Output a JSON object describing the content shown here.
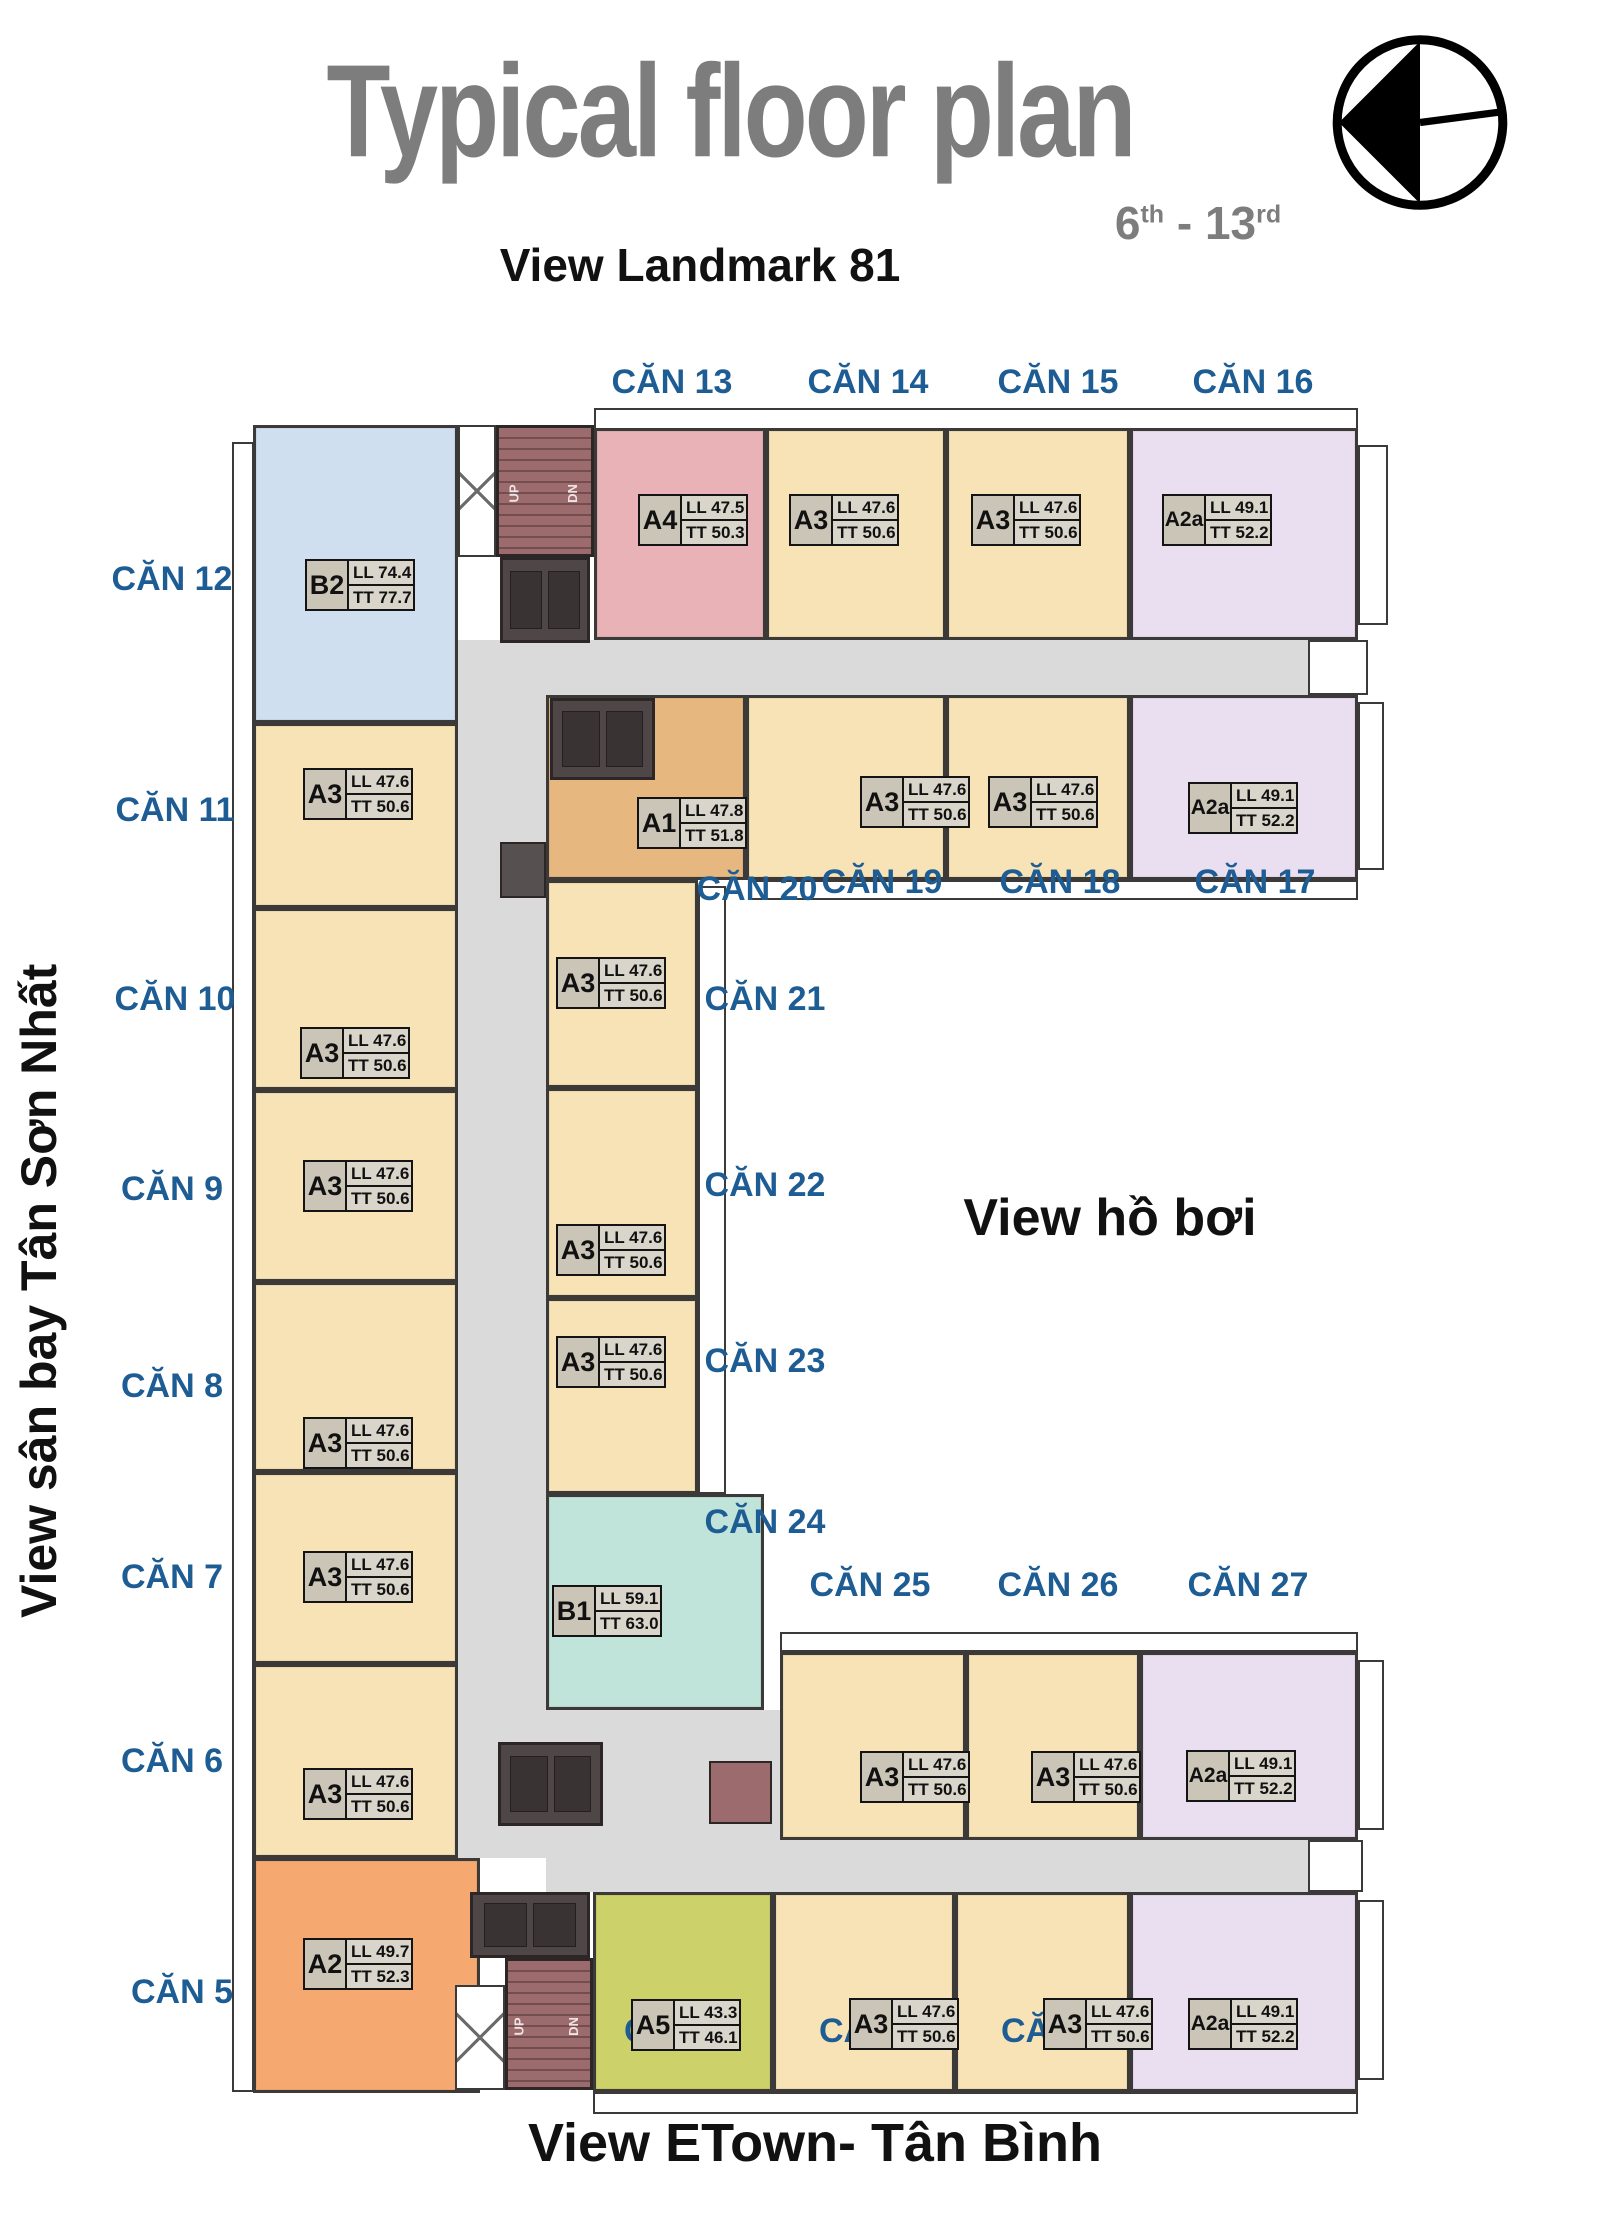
{
  "header": {
    "title": "Typical floor plan",
    "floors": {
      "from": "6",
      "from_sup": "th",
      "sep": " - ",
      "to": "13",
      "to_sup": "rd"
    },
    "subtitle": "View Landmark 81"
  },
  "views": {
    "left": "View sân bay Tân Sơn Nhất",
    "pool": "View hồ bơi",
    "bottom": "View ETown- Tân Bình"
  },
  "stairs": {
    "up": "UP",
    "dn": "DN"
  },
  "palette": {
    "a3": "#f8e3b6",
    "a4": "#e9b2b7",
    "a2a": "#eadef1",
    "b2": "#cfdff0",
    "a1": "#e6b77f",
    "b1": "#c0e3da",
    "a2": "#f5a870",
    "a5": "#cdd169",
    "corridor": "#dadada",
    "stair": "#9c6b6e",
    "elevator": "#4e4647",
    "label_blue": "#1e5c94",
    "title_gray": "#7d7d7d"
  },
  "units": [
    {
      "label": "CĂN 1",
      "type": "A2a",
      "ll": "LL 49.1",
      "tt": "TT 52.2"
    },
    {
      "label": "CĂN 2",
      "type": "A3",
      "ll": "LL 47.6",
      "tt": "TT 50.6"
    },
    {
      "label": "CĂN 3",
      "type": "A3",
      "ll": "LL 47.6",
      "tt": "TT 50.6"
    },
    {
      "label": "CĂN 4",
      "type": "A5",
      "ll": "LL 43.3",
      "tt": "TT 46.1"
    },
    {
      "label": "CĂN 5",
      "type": "A2",
      "ll": "LL 49.7",
      "tt": "TT 52.3"
    },
    {
      "label": "CĂN 6",
      "type": "A3",
      "ll": "LL 47.6",
      "tt": "TT 50.6"
    },
    {
      "label": "CĂN 7",
      "type": "A3",
      "ll": "LL 47.6",
      "tt": "TT 50.6"
    },
    {
      "label": "CĂN 8",
      "type": "A3",
      "ll": "LL 47.6",
      "tt": "TT 50.6"
    },
    {
      "label": "CĂN 9",
      "type": "A3",
      "ll": "LL 47.6",
      "tt": "TT 50.6"
    },
    {
      "label": "CĂN 10",
      "type": "A3",
      "ll": "LL 47.6",
      "tt": "TT 50.6"
    },
    {
      "label": "CĂN 11",
      "type": "A3",
      "ll": "LL 47.6",
      "tt": "TT 50.6"
    },
    {
      "label": "CĂN 12",
      "type": "B2",
      "ll": "LL 74.4",
      "tt": "TT 77.7"
    },
    {
      "label": "CĂN 13",
      "type": "A4",
      "ll": "LL 47.5",
      "tt": "TT 50.3"
    },
    {
      "label": "CĂN 14",
      "type": "A3",
      "ll": "LL 47.6",
      "tt": "TT 50.6"
    },
    {
      "label": "CĂN 15",
      "type": "A3",
      "ll": "LL 47.6",
      "tt": "TT 50.6"
    },
    {
      "label": "CĂN 16",
      "type": "A2a",
      "ll": "LL 49.1",
      "tt": "TT 52.2"
    },
    {
      "label": "CĂN 17",
      "type": "A2a",
      "ll": "LL 49.1",
      "tt": "TT 52.2"
    },
    {
      "label": "CĂN 18",
      "type": "A3",
      "ll": "LL 47.6",
      "tt": "TT 50.6"
    },
    {
      "label": "CĂN 19",
      "type": "A3",
      "ll": "LL 47.6",
      "tt": "TT 50.6"
    },
    {
      "label": "CĂN 20",
      "type": "A1",
      "ll": "LL 47.8",
      "tt": "TT 51.8"
    },
    {
      "label": "CĂN 21",
      "type": "A3",
      "ll": "LL 47.6",
      "tt": "TT 50.6"
    },
    {
      "label": "CĂN 22",
      "type": "A3",
      "ll": "LL 47.6",
      "tt": "TT 50.6"
    },
    {
      "label": "CĂN 23",
      "type": "A3",
      "ll": "LL 47.6",
      "tt": "TT 50.6"
    },
    {
      "label": "CĂN 24",
      "type": "B1",
      "ll": "LL 59.1",
      "tt": "TT 63.0"
    },
    {
      "label": "CĂN 25",
      "type": "A3",
      "ll": "LL 47.6",
      "tt": "TT 50.6"
    },
    {
      "label": "CĂN 26",
      "type": "A3",
      "ll": "LL 47.6",
      "tt": "TT 50.6"
    },
    {
      "label": "CĂN 27",
      "type": "A2a",
      "ll": "LL 49.1",
      "tt": "TT 52.2"
    }
  ]
}
